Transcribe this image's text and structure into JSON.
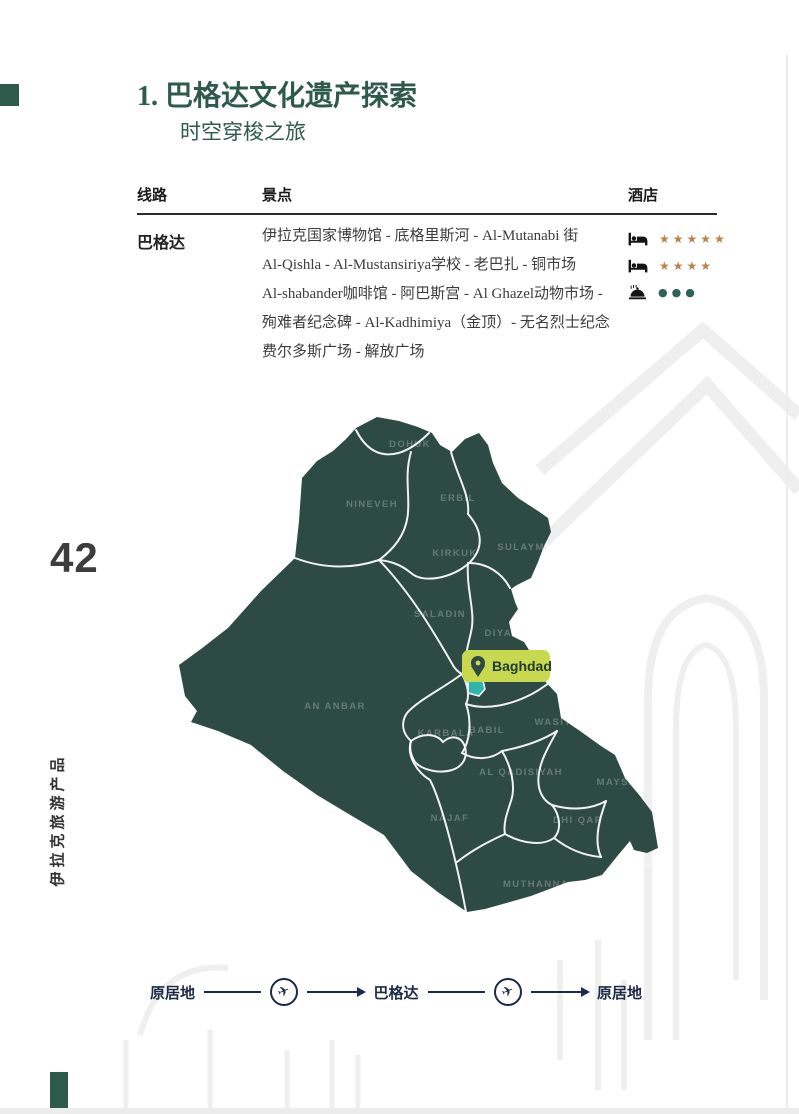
{
  "page": {
    "number": "42",
    "side_label": "伊拉克旅游产品"
  },
  "header": {
    "title": "1. 巴格达文化遗产探索",
    "subtitle": "时空穿梭之旅"
  },
  "table": {
    "col_route": "线路",
    "col_attractions": "景点",
    "col_hotel": "酒店",
    "route": "巴格达",
    "attractions": [
      "伊拉克国家博物馆 - 底格里斯河 - Al-Mutanabi 街",
      "Al-Qishla - Al-Mustansiriya学校 - 老巴扎 - 铜市场",
      "Al-shabander咖啡馆 - 阿巴斯宫 - Al Ghazel动物市场 -",
      "殉难者纪念碑 - Al-Kadhimiya（金顶）- 无名烈士纪念",
      "费尔多斯广场 - 解放广场"
    ],
    "hotels": [
      {
        "icon": "bed-icon",
        "rating": "★★★★★"
      },
      {
        "icon": "bed-icon",
        "rating": "★★★★"
      },
      {
        "icon": "dining-icon",
        "rating": "●●●"
      }
    ]
  },
  "map": {
    "provinces": [
      "DOHUK",
      "NINEVEH",
      "ERBIL",
      "KIRKUK",
      "SULAYMANIYAH",
      "SALADIN",
      "DIYALA",
      "AN ANBAR",
      "KARBALA",
      "BABIL",
      "WASIT",
      "AL QADISIYAH",
      "MAYSAN",
      "NAJAF",
      "DHI QAR",
      "MUTHANNA",
      "BASRA"
    ],
    "marker_label": "Baghdad",
    "colors": {
      "land": "#2d4a44",
      "border": "#ffffff",
      "highlight": "#2fb5ae",
      "badge": "#c9d94f"
    }
  },
  "itinerary": {
    "origin": "原居地",
    "destination": "巴格达",
    "return": "原居地"
  }
}
